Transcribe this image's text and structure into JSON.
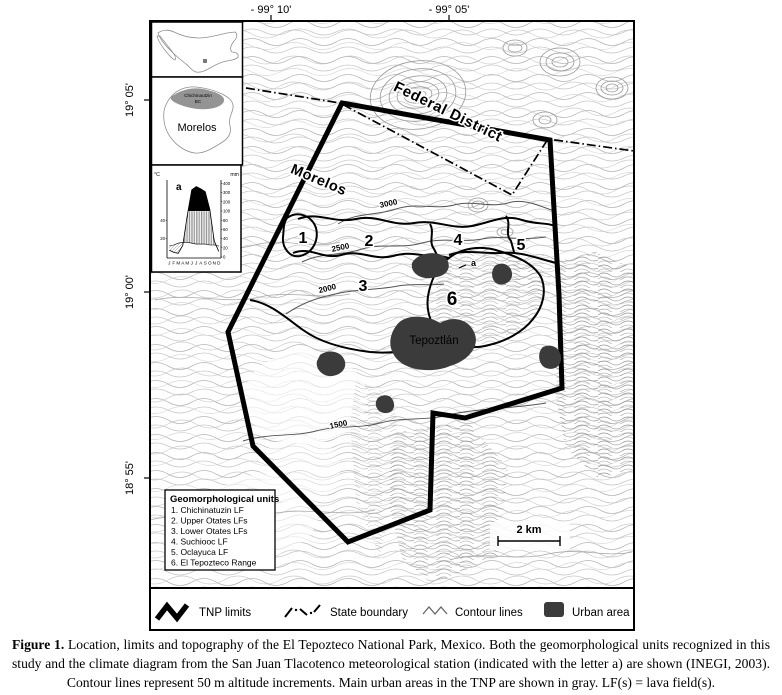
{
  "axis": {
    "top": [
      "- 99° 10'",
      "- 99° 05'"
    ],
    "left": [
      "19° 05'",
      "19° 00'",
      "18° 55'"
    ]
  },
  "map_labels": {
    "federal_district": "Federal District",
    "morelos": "Morelos",
    "tepoztlan": "Tepoztlán",
    "station": "a",
    "scale": "2 km",
    "contours": [
      "3000",
      "2500",
      "2000",
      "1500"
    ],
    "units": [
      "1",
      "2",
      "3",
      "4",
      "5",
      "6"
    ]
  },
  "insets": {
    "morelos_state": "Morelos",
    "chichinautzin_line1": "Chichinautzin",
    "chichinautzin_line2": "BC"
  },
  "climate": {
    "station_letter": "a",
    "unit_left": "°C",
    "unit_right": "mm",
    "mm_ticks": [
      "400",
      "300",
      "200",
      "100",
      "80",
      "60",
      "40",
      "20",
      "0"
    ],
    "c_ticks": [
      "40",
      "20"
    ],
    "months": [
      "J",
      "F",
      "M",
      "A",
      "M",
      "J",
      "J",
      "A",
      "S",
      "O",
      "N",
      "D"
    ]
  },
  "geo_units": {
    "title": "Geomorphological units",
    "items": [
      "1. Chichinatuzin LF",
      "2. Upper Otates LFs",
      "3. Lower Otates LFs",
      "4. Suchiooc LF",
      "5. Oclayuca LF",
      "6. El Tepozteco Range"
    ]
  },
  "legend": {
    "tnp": "TNP limits",
    "state": "State boundary",
    "contour": "Contour lines",
    "urban": "Urban area"
  },
  "caption": {
    "label": "Figure 1.",
    "text": " Location, limits and topography of the El Tepozteco National Park, Mexico. Both the geomorphological units recognized in this study and the climate diagram from the San Juan Tlacotenco meteorological station (indicated with the letter a) are shown (INEGI, 2003). Contour lines represent 50 m altitude increments. Main urban areas in the TNP are shown in gray. LF(s) = lava field(s)."
  },
  "chart_data": {
    "type": "area",
    "title": "Climate diagram, San Juan Tlacotenco meteorological station (a)",
    "categories": [
      "J",
      "F",
      "M",
      "A",
      "M",
      "J",
      "J",
      "A",
      "S",
      "O",
      "N",
      "D"
    ],
    "series": [
      {
        "name": "Precipitation (mm)",
        "values": [
          15,
          10,
          8,
          25,
          90,
          330,
          365,
          340,
          310,
          120,
          35,
          12
        ]
      },
      {
        "name": "Temperature (°C)",
        "values": [
          12,
          13,
          15,
          16,
          16,
          15,
          14,
          14,
          14,
          13,
          13,
          12
        ]
      }
    ],
    "ylabel_left": "°C",
    "ylabel_right": "mm",
    "right_axis_ticks": [
      400,
      300,
      200,
      100,
      80,
      60,
      40,
      20,
      0
    ],
    "left_axis_ticks": [
      40,
      20
    ],
    "ylim_right": [
      0,
      400
    ]
  },
  "colors": {
    "urban": "#3b3b3b",
    "contour_light": "#b8b8b8",
    "contour_dark": "#555555",
    "boundary": "#000000"
  }
}
